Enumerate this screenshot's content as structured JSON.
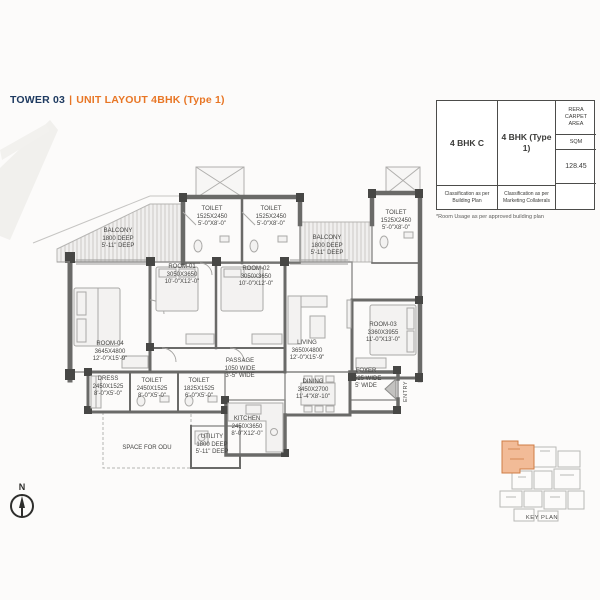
{
  "header": {
    "tower": "TOWER 03",
    "separator": "|",
    "layout_title": "UNIT LAYOUT 4BHK (Type 1)"
  },
  "spec_table": {
    "building_plan_name": "4 BHK C",
    "building_plan_note": "Classification as per Building Plan",
    "marketing_name": "4 BHK (Type 1)",
    "marketing_note": "Classification as per Marketing Collaterals",
    "area_header": "RERA\nCARPET\nAREA",
    "area_unit": "SQM",
    "area_value": "128.45",
    "footnote": "*Room Usage as per approved building plan"
  },
  "floor_plan": {
    "entry_label": "ENTRY",
    "rooms": [
      {
        "id": "balcony-left",
        "lines": [
          "BALCONY",
          "1800 DEEP",
          "5'-11\" DEEP"
        ],
        "x": 118,
        "y": 228
      },
      {
        "id": "toilet-top-1",
        "lines": [
          "TOILET",
          "1525X2450",
          "5'-0\"X8'-0\""
        ],
        "x": 212,
        "y": 206
      },
      {
        "id": "toilet-top-2",
        "lines": [
          "TOILET",
          "1525X2450",
          "5'-0\"X8'-0\""
        ],
        "x": 271,
        "y": 206
      },
      {
        "id": "toilet-top-right",
        "lines": [
          "TOILET",
          "1525X2450",
          "5'-0\"X8'-0\""
        ],
        "x": 396,
        "y": 210
      },
      {
        "id": "balcony-mid",
        "lines": [
          "BALCONY",
          "1800 DEEP",
          "5'-11\" DEEP"
        ],
        "x": 327,
        "y": 235
      },
      {
        "id": "room-01",
        "lines": [
          "ROOM-01",
          "3050X3650",
          "10'-0\"X12'-0\""
        ],
        "x": 182,
        "y": 264
      },
      {
        "id": "room-02",
        "lines": [
          "ROOM-02",
          "3050X3650",
          "10'-0\"X12'-0\""
        ],
        "x": 256,
        "y": 266
      },
      {
        "id": "room-03",
        "lines": [
          "ROOM-03",
          "3360X3955",
          "11'-0\"X13'-0\""
        ],
        "x": 383,
        "y": 322
      },
      {
        "id": "room-04",
        "lines": [
          "ROOM-04",
          "3645X4800",
          "12'-0\"X15'-9\""
        ],
        "x": 110,
        "y": 341
      },
      {
        "id": "living",
        "lines": [
          "LIVING",
          "3650X4800",
          "12'-0\"X15'-9\""
        ],
        "x": 307,
        "y": 340
      },
      {
        "id": "passage",
        "lines": [
          "PASSAGE",
          "1050 WIDE",
          "3'-5\" WIDE"
        ],
        "x": 240,
        "y": 358
      },
      {
        "id": "dress",
        "lines": [
          "DRESS",
          "2450X1525",
          "8'-0\"X5'-0\""
        ],
        "x": 108,
        "y": 376
      },
      {
        "id": "toilet-room04",
        "lines": [
          "TOILET",
          "2450X1525",
          "8'-0\"X5'-0\""
        ],
        "x": 152,
        "y": 378
      },
      {
        "id": "toilet-room01",
        "lines": [
          "TOILET",
          "1825X1525",
          "6'-0\"X5'-0\""
        ],
        "x": 199,
        "y": 378
      },
      {
        "id": "dining",
        "lines": [
          "DINING",
          "3450X2700",
          "11'-4\"X8'-10\""
        ],
        "x": 313,
        "y": 379
      },
      {
        "id": "foyer",
        "lines": [
          "FOYER",
          "1525 WIDE",
          "5' WIDE"
        ],
        "x": 366,
        "y": 368
      },
      {
        "id": "kitchen",
        "lines": [
          "KITCHEN",
          "2450X3650",
          "8'-0\"X12'-0\""
        ],
        "x": 247,
        "y": 416
      },
      {
        "id": "utility",
        "lines": [
          "UTILITY",
          "1800 DEEP",
          "5'-11\" DEEP"
        ],
        "x": 212,
        "y": 434
      },
      {
        "id": "space-odu",
        "lines": [
          "SPACE FOR ODU"
        ],
        "x": 147,
        "y": 445
      }
    ]
  },
  "compass": {
    "label": "N"
  },
  "key_plan": {
    "label": "KEY PLAN"
  },
  "colors": {
    "accent_orange": "#E87625",
    "navy": "#1E3A60",
    "wall_gray": "#6A6A6A",
    "pier_dark": "#474745",
    "keyplan_highlight": "#F2BB97"
  }
}
